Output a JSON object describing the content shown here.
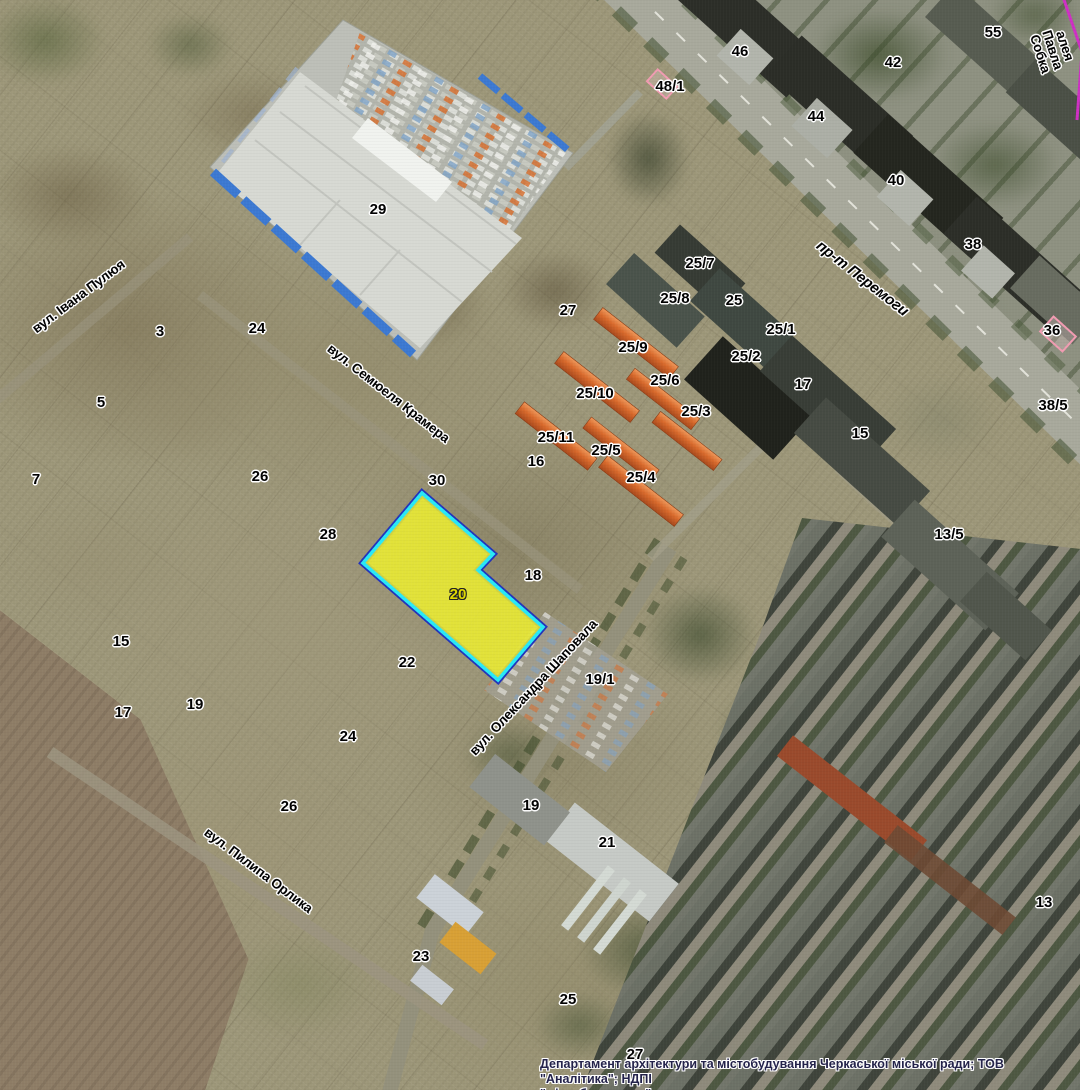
{
  "map": {
    "attribution": {
      "line1": "Департамент архітектури та містобудування Черкаської міської ради; ТОВ \"Аналітика\"; НДПІ",
      "line2": "\"містобудування\""
    },
    "highlighted_parcel": {
      "number": "20",
      "x": 458,
      "y": 595,
      "fill_color": "#eef02f",
      "border_inner_color": "#29e9f7",
      "border_outer_color": "#2233bb",
      "label_color": "#e2da00"
    },
    "street_labels": [
      {
        "name": "вул. Івана Пулюя",
        "x": 79,
        "y": 297,
        "angle": -37,
        "italic": false
      },
      {
        "name": "вул. Семюеля Крамера",
        "x": 388,
        "y": 394,
        "angle": 38,
        "italic": false
      },
      {
        "name": "пр-т Перемоги",
        "x": 862,
        "y": 279,
        "angle": 38,
        "italic": true
      },
      {
        "name": "алея Павла\nСобка",
        "x": 1052,
        "y": 50,
        "angle": 72,
        "italic": false
      },
      {
        "name": "вул. Олександра Шаповала",
        "x": 534,
        "y": 688,
        "angle": -47,
        "italic": false
      },
      {
        "name": "вул. Пилипа Орлика",
        "x": 258,
        "y": 871,
        "angle": 37,
        "italic": false
      }
    ],
    "parcel_labels": [
      {
        "text": "46",
        "x": 740,
        "y": 52
      },
      {
        "text": "55",
        "x": 993,
        "y": 33
      },
      {
        "text": "42",
        "x": 893,
        "y": 63
      },
      {
        "text": "48/1",
        "x": 670,
        "y": 87
      },
      {
        "text": "44",
        "x": 816,
        "y": 117
      },
      {
        "text": "40",
        "x": 896,
        "y": 181
      },
      {
        "text": "38",
        "x": 973,
        "y": 245
      },
      {
        "text": "29",
        "x": 378,
        "y": 210
      },
      {
        "text": "27",
        "x": 568,
        "y": 311
      },
      {
        "text": "25/7",
        "x": 700,
        "y": 264
      },
      {
        "text": "25/8",
        "x": 675,
        "y": 299
      },
      {
        "text": "25",
        "x": 734,
        "y": 301
      },
      {
        "text": "25/1",
        "x": 781,
        "y": 330
      },
      {
        "text": "36",
        "x": 1052,
        "y": 331
      },
      {
        "text": "25/9",
        "x": 633,
        "y": 348
      },
      {
        "text": "25/2",
        "x": 746,
        "y": 357
      },
      {
        "text": "25/6",
        "x": 665,
        "y": 381
      },
      {
        "text": "17",
        "x": 803,
        "y": 385
      },
      {
        "text": "25/10",
        "x": 595,
        "y": 394
      },
      {
        "text": "38/5",
        "x": 1053,
        "y": 406
      },
      {
        "text": "25/3",
        "x": 696,
        "y": 412
      },
      {
        "text": "3",
        "x": 160,
        "y": 332
      },
      {
        "text": "24",
        "x": 257,
        "y": 329
      },
      {
        "text": "5",
        "x": 101,
        "y": 403
      },
      {
        "text": "25/11",
        "x": 556,
        "y": 438
      },
      {
        "text": "25/5",
        "x": 606,
        "y": 451
      },
      {
        "text": "15",
        "x": 860,
        "y": 434
      },
      {
        "text": "16",
        "x": 536,
        "y": 462
      },
      {
        "text": "25/4",
        "x": 641,
        "y": 478
      },
      {
        "text": "7",
        "x": 36,
        "y": 480
      },
      {
        "text": "26",
        "x": 260,
        "y": 477
      },
      {
        "text": "30",
        "x": 437,
        "y": 481
      },
      {
        "text": "28",
        "x": 328,
        "y": 535
      },
      {
        "text": "13/5",
        "x": 949,
        "y": 535
      },
      {
        "text": "18",
        "x": 533,
        "y": 576
      },
      {
        "text": "15",
        "x": 121,
        "y": 642
      },
      {
        "text": "22",
        "x": 407,
        "y": 663
      },
      {
        "text": "19/1",
        "x": 600,
        "y": 680
      },
      {
        "text": "19",
        "x": 195,
        "y": 705
      },
      {
        "text": "17",
        "x": 123,
        "y": 713
      },
      {
        "text": "24",
        "x": 348,
        "y": 737
      },
      {
        "text": "19",
        "x": 531,
        "y": 806
      },
      {
        "text": "26",
        "x": 289,
        "y": 807
      },
      {
        "text": "21",
        "x": 607,
        "y": 843
      },
      {
        "text": "13",
        "x": 1044,
        "y": 903
      },
      {
        "text": "23",
        "x": 421,
        "y": 957
      },
      {
        "text": "25",
        "x": 568,
        "y": 1000
      },
      {
        "text": "27",
        "x": 635,
        "y": 1055
      }
    ]
  }
}
